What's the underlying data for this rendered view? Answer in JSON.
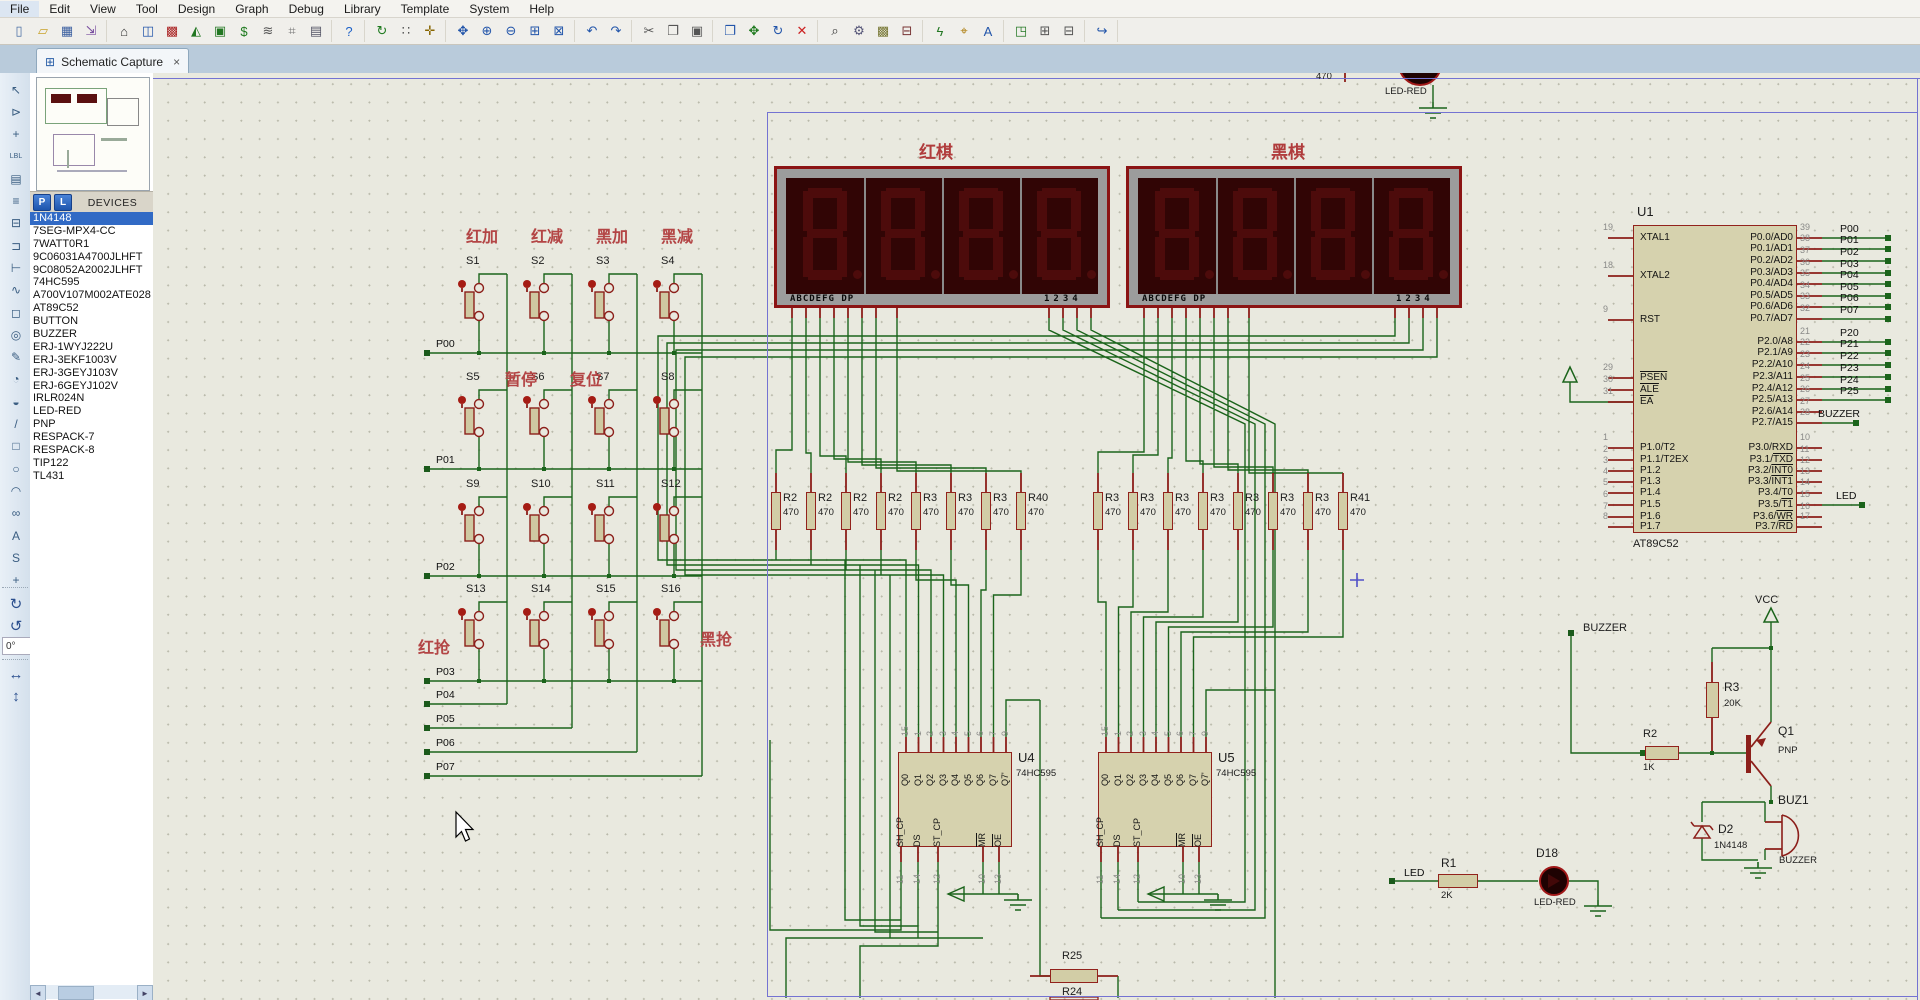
{
  "menu": {
    "items": [
      "File",
      "Edit",
      "View",
      "Tool",
      "Design",
      "Graph",
      "Debug",
      "Library",
      "Template",
      "System",
      "Help"
    ]
  },
  "toolbar": {
    "groups": [
      [
        "new-project",
        "open-project",
        "save-project",
        "import-legacy"
      ],
      [
        "home",
        "schematic-capture",
        "pcb-layout",
        "3d-visualizer",
        "design-explorer",
        "bill-of-materials",
        "electrical-rule-check",
        "measurement",
        "documentation"
      ],
      [
        "help"
      ],
      [
        "refresh-display",
        "toggle-grid",
        "false-origin"
      ],
      [
        "center-at-cursor",
        "zoom-in",
        "zoom-out",
        "zoom-area",
        "zoom-sheet"
      ],
      [
        "undo",
        "redo"
      ],
      [
        "cut",
        "copy",
        "paste"
      ],
      [
        "block-copy",
        "block-move",
        "block-rotate",
        "block-delete"
      ],
      [
        "pick-parts",
        "make-device",
        "packaging-tool",
        "decompose"
      ],
      [
        "wire-autorouter",
        "search-tag",
        "property-assignment-tool"
      ],
      [
        "design-explorer-2",
        "new-sheet",
        "remove-sheet"
      ],
      [
        "exit-to-parent"
      ]
    ]
  },
  "tab": {
    "label": "Schematic Capture"
  },
  "sidebar": {
    "p_button": "P",
    "l_button": "L",
    "header": "DEVICES",
    "selected_index": 0,
    "devices": [
      "1N4148",
      "7SEG-MPX4-CC",
      "7WATT0R1",
      "9C06031A4700JLHFT",
      "9C08052A2002JLHFT",
      "74HC595",
      "A700V107M002ATE028",
      "AT89C52",
      "BUTTON",
      "BUZZER",
      "ERJ-1WYJ222U",
      "ERJ-3EKF1003V",
      "ERJ-3GEYJ103V",
      "ERJ-6GEYJ102V",
      "IRLR024N",
      "LED-RED",
      "PNP",
      "RESPACK-7",
      "RESPACK-8",
      "TIP122",
      "TL431"
    ]
  },
  "mode_toolbar": {
    "icons": [
      "selection-mode",
      "component-mode",
      "junction-dot-mode",
      "wire-label-mode",
      "text-script-mode",
      "buses-mode",
      "subcircuit-mode",
      "terminals-mode",
      "device-pins-mode",
      "graph-mode",
      "tape-recorder-mode",
      "generator-mode",
      "voltage-probe-mode",
      "current-probe-mode",
      "virtual-instruments-mode",
      "2d-line",
      "2d-box",
      "2d-circle",
      "2d-arc",
      "2d-path",
      "2d-text",
      "2d-symbol",
      "2d-markers"
    ]
  },
  "rotation": {
    "angle": "0°"
  },
  "schematic": {
    "titles": {
      "red_display": "红棋",
      "black_display": "黑棋"
    },
    "display": {
      "segment_text": "ABCDEFG DP",
      "digit_text": "1234"
    },
    "keypad": {
      "col_headers": [
        "红加",
        "红减",
        "黑加",
        "黑减"
      ],
      "mid_labels": [
        "暂停",
        "复位"
      ],
      "corner_labels": [
        "红抢",
        "黑抢"
      ],
      "buttons": [
        "S1",
        "S2",
        "S3",
        "S4",
        "S5",
        "S6",
        "S7",
        "S8",
        "S9",
        "S10",
        "S11",
        "S12",
        "S13",
        "S14",
        "S15",
        "S16"
      ],
      "row_nets": [
        "P00",
        "P01",
        "P02",
        "P03"
      ],
      "col_nets": [
        "P04",
        "P05",
        "P06",
        "P07"
      ]
    },
    "res_bank_left": {
      "labels": [
        "R2",
        "R2",
        "R2",
        "R2",
        "R3",
        "R3",
        "R3",
        "R40"
      ],
      "value": "470"
    },
    "res_bank_right": {
      "labels": [
        "R3",
        "R3",
        "R3",
        "R3",
        "R3",
        "R3",
        "R3",
        "R41"
      ],
      "value": "470"
    },
    "u1": {
      "ref": "U1",
      "value": "AT89C52",
      "left_pins": [
        {
          "num": "19",
          "name": "XTAL1"
        },
        {
          "num": "18",
          "name": "XTAL2"
        },
        {
          "num": "9",
          "name": "RST"
        },
        {
          "num": "29",
          "name": "",
          "ov": "PSEN"
        },
        {
          "num": "30",
          "name": "",
          "ov": "ALE"
        },
        {
          "num": "31",
          "name": "",
          "ov": "EA"
        },
        {
          "num": "1",
          "name": "P1.0/T2"
        },
        {
          "num": "2",
          "name": "P1.1/T2EX"
        },
        {
          "num": "3",
          "name": "P1.2"
        },
        {
          "num": "4",
          "name": "P1.3"
        },
        {
          "num": "5",
          "name": "P1.4"
        },
        {
          "num": "6",
          "name": "P1.5"
        },
        {
          "num": "7",
          "name": "P1.6"
        },
        {
          "num": "8",
          "name": "P1.7"
        }
      ],
      "right_pins_p0": [
        {
          "num": "39",
          "name": "P0.0/AD0"
        },
        {
          "num": "38",
          "name": "P0.1/AD1"
        },
        {
          "num": "37",
          "name": "P0.2/AD2"
        },
        {
          "num": "36",
          "name": "P0.3/AD3"
        },
        {
          "num": "35",
          "name": "P0.4/AD4"
        },
        {
          "num": "34",
          "name": "P0.5/AD5"
        },
        {
          "num": "33",
          "name": "P0.6/AD6"
        },
        {
          "num": "32",
          "name": "P0.7/AD7"
        }
      ],
      "right_pins_p2": [
        {
          "num": "21",
          "name": "P2.0/A8"
        },
        {
          "num": "22",
          "name": "P2.1/A9"
        },
        {
          "num": "23",
          "name": "P2.2/A10"
        },
        {
          "num": "24",
          "name": "P2.3/A11"
        },
        {
          "num": "25",
          "name": "P2.4/A12"
        },
        {
          "num": "26",
          "name": "P2.5/A13"
        },
        {
          "num": "27",
          "name": "P2.6/A14"
        },
        {
          "num": "28",
          "name": "P2.7/A15"
        }
      ],
      "right_pins_p3": [
        {
          "num": "10",
          "name": "P3.0/RXD"
        },
        {
          "num": "11",
          "name": "P3.1/",
          "ov": "TXD"
        },
        {
          "num": "12",
          "name": "P3.2/",
          "ov": "INT0"
        },
        {
          "num": "13",
          "name": "P3.3/",
          "ov": "INT1"
        },
        {
          "num": "14",
          "name": "P3.4/T0"
        },
        {
          "num": "15",
          "name": "P3.5/",
          "ov": "T1"
        },
        {
          "num": "16",
          "name": "P3.6/",
          "ov": "WR"
        },
        {
          "num": "17",
          "name": "P3.7/",
          "ov": "RD"
        }
      ],
      "net_labels_p0": [
        "P00",
        "P01",
        "P02",
        "P03",
        "P04",
        "P05",
        "P06",
        "P07"
      ],
      "net_labels_p2": [
        "P20",
        "P21",
        "P22",
        "P23",
        "P24",
        "P25"
      ],
      "buzzer_net": "BUZZER",
      "led_net": "LED"
    },
    "u4": {
      "ref": "U4",
      "value": "74HC595"
    },
    "u5": {
      "ref": "U5",
      "value": "74HC595"
    },
    "hc595": {
      "top_numbers": [
        "15",
        "1",
        "2",
        "3",
        "4",
        "5",
        "6",
        "7",
        "9"
      ],
      "top_names": [
        "Q0",
        "Q1",
        "Q2",
        "Q3",
        "Q4",
        "Q5",
        "Q6",
        "Q7",
        "Q7'"
      ],
      "bottom_pins": [
        {
          "name": "SH_CP",
          "num": "11",
          "ov": false
        },
        {
          "name": "DS",
          "num": "14",
          "ov": false
        },
        {
          "name": "ST_CP",
          "num": "12",
          "ov": false
        },
        {
          "name": "MR",
          "num": "10",
          "ov": true
        },
        {
          "name": "OE",
          "num": "13",
          "ov": true
        }
      ]
    },
    "driver": {
      "buzzer_terminal": "BUZZER",
      "vcc": "VCC",
      "r3": {
        "ref": "R3",
        "value": "20K"
      },
      "r2": {
        "ref": "R2",
        "value": "1K"
      },
      "q1": {
        "ref": "Q1",
        "value": "PNP"
      },
      "d2": {
        "ref": "D2",
        "value": "1N4148"
      },
      "buz1": {
        "ref": "BUZ1",
        "value": "BUZZER"
      }
    },
    "led_circuit": {
      "terminal": "LED",
      "r1": {
        "ref": "R1",
        "value": "2K"
      },
      "d18": {
        "ref": "D18",
        "value": "LED-RED"
      }
    },
    "top_right": {
      "value": "470",
      "part": "LED-RED"
    },
    "bottom": {
      "r25": "R25",
      "r24": "R24"
    }
  }
}
